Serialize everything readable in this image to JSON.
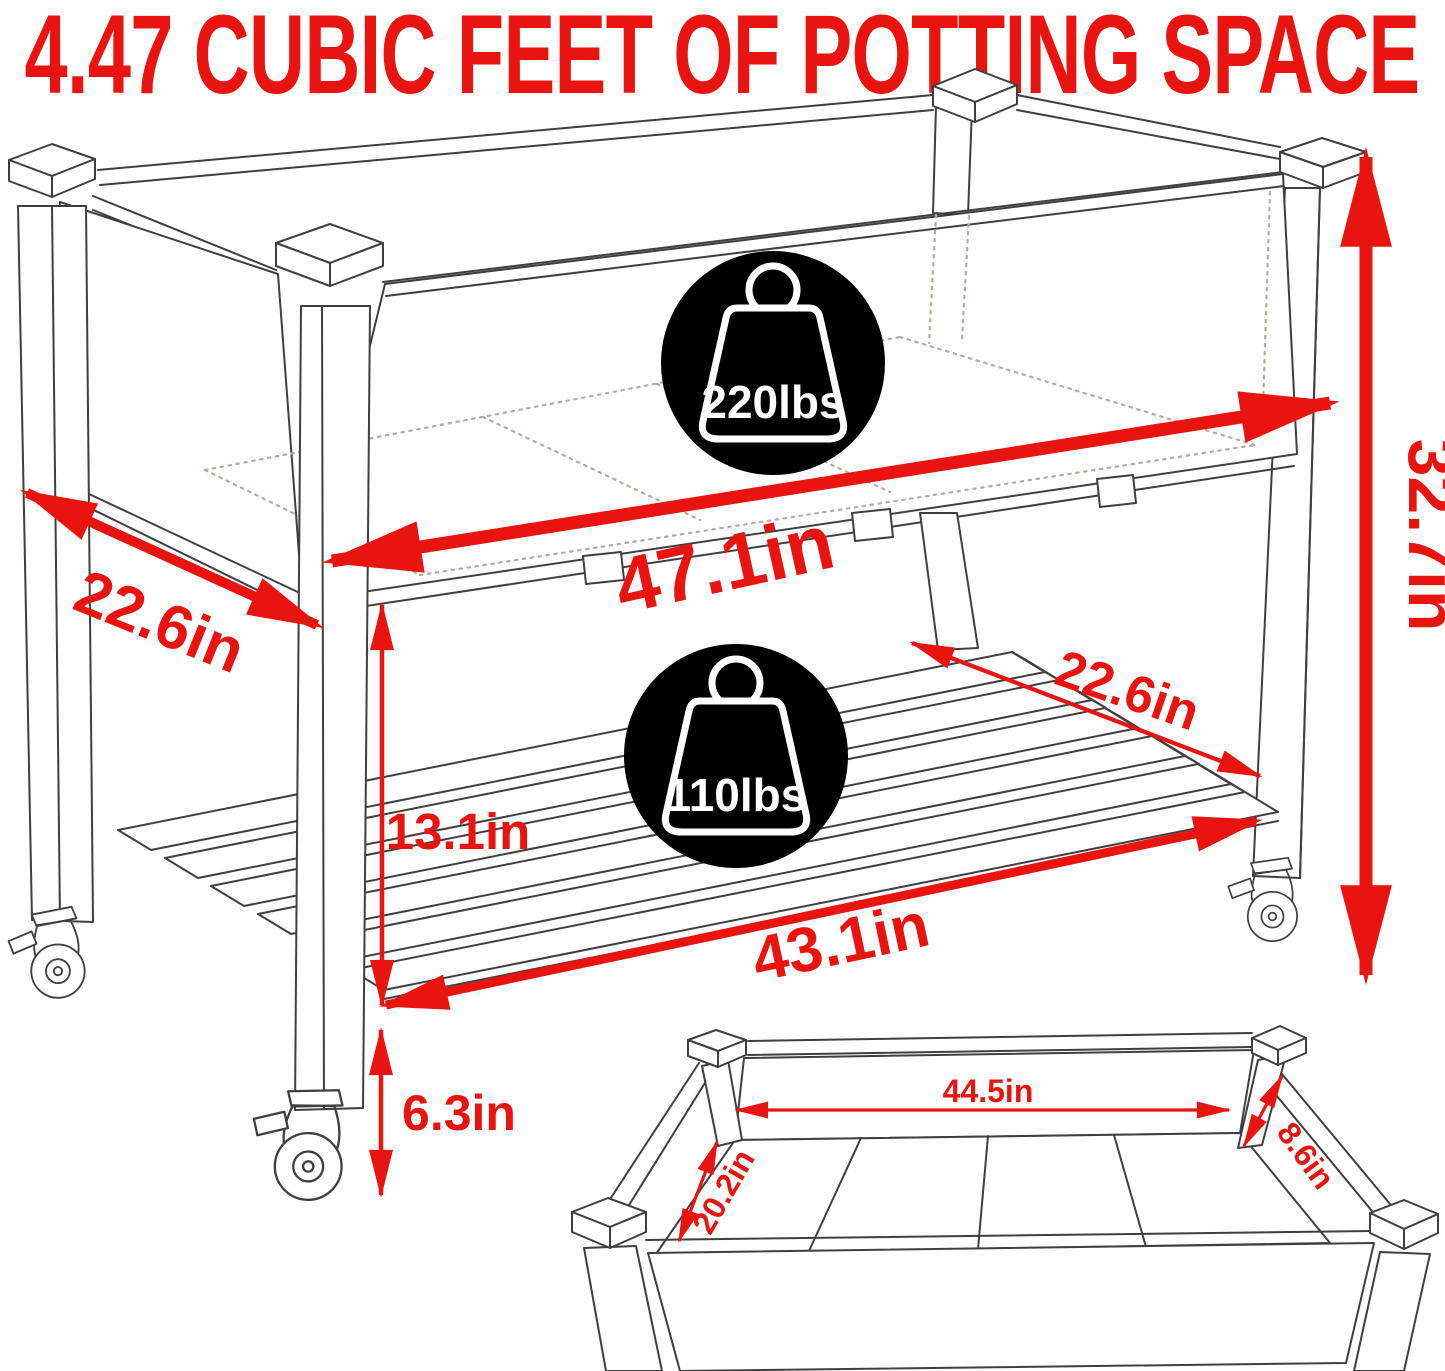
{
  "title": "4.47 CUBIC FEET OF POTTING SPACE",
  "colors": {
    "accent": "#e9140f",
    "line": "#3f3f3f",
    "hidden_line": "#b8a9a1",
    "badge_bg": "#000000",
    "badge_fg": "#ffffff",
    "background": "#ffffff"
  },
  "capacity_badges": {
    "upper": {
      "icon": "weight-icon",
      "label": "220lbs"
    },
    "lower": {
      "icon": "weight-icon",
      "label": "110lbs"
    }
  },
  "main_dimensions": {
    "bed_depth": "22.6in",
    "bed_length": "47.1in",
    "overall_height": "32.7in",
    "shelf_depth": "22.6in",
    "shelf_clearance": "13.1in",
    "shelf_length": "43.1in",
    "ground_clearance": "6.3in"
  },
  "insert_dimensions": {
    "inner_length": "44.5in",
    "inner_width": "20.2in",
    "inner_depth": "8.6in"
  }
}
